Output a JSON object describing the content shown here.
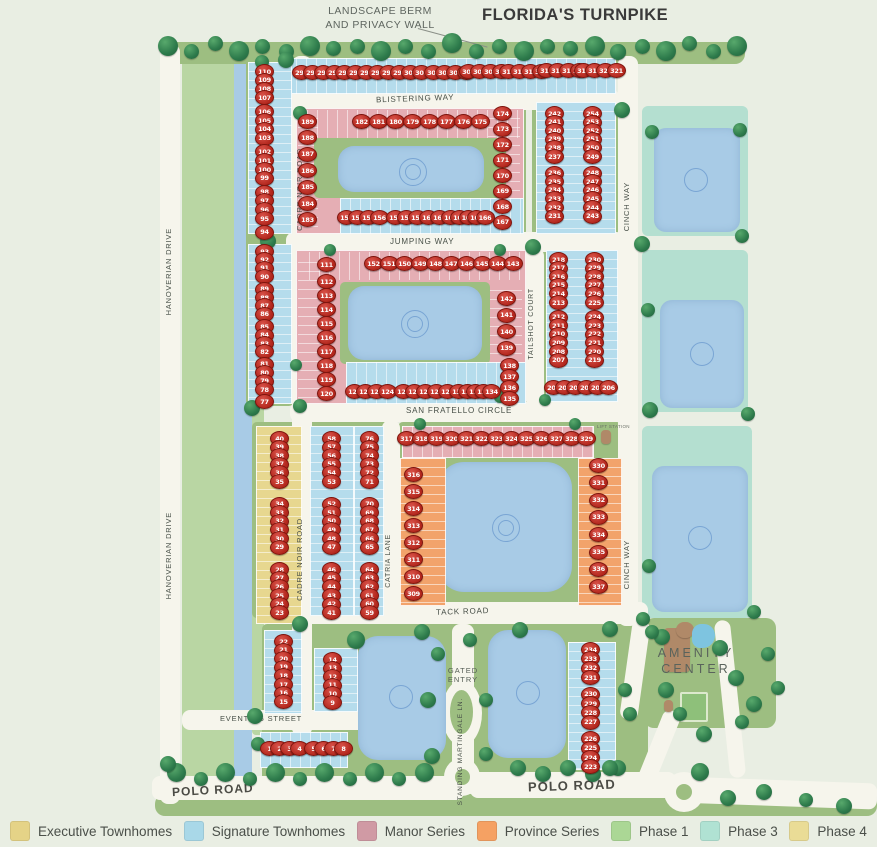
{
  "title": "FLORIDA'S TURNPIKE",
  "annotations": {
    "berm_line1": "LANDSCAPE BERM",
    "berm_line2": "AND PRIVACY WALL",
    "gated_line1": "GATED",
    "gated_line2": "ENTRY",
    "amenity_line1": "AMENITY",
    "amenity_line2": "CENTER",
    "lift_station": "LIFT STATION"
  },
  "roads": {
    "blistering": "BLISTERING WAY",
    "jumping": "JUMPING WAY",
    "fratello": "SAN FRATELLO CIRCLE",
    "tack": "TACK ROAD",
    "eventing": "EVENTING STREET",
    "polo_west": "POLO ROAD",
    "polo_east": "POLO ROAD",
    "cadre_north": "CADRE NOIR ROAD",
    "cadre_south": "CADRE NOIR ROAD",
    "hanoverian_north": "HANOVERIAN DRIVE",
    "hanoverian_south": "HANOVERIAN DRIVE",
    "cinch_north": "CINCH WAY",
    "cinch_south": "CINCH WAY",
    "tailshot": "TAILSHOT COURT",
    "catria": "CATRIA LANE",
    "standing": "STANDING MARTINGALE LN."
  },
  "legend": {
    "items": [
      {
        "label": "Executive Townhomes",
        "color": "#e5d387"
      },
      {
        "label": "Signature Townhomes",
        "color": "#a9d8e8"
      },
      {
        "label": "Manor Series",
        "color": "#d09aa4"
      },
      {
        "label": "Province Series",
        "color": "#f5a163"
      },
      {
        "label": "Phase 1",
        "color": "#abd795"
      },
      {
        "label": "Phase 3",
        "color": "#b0e2d3"
      },
      {
        "label": "Phase 4",
        "color": "#eadc96"
      }
    ]
  },
  "lots": {
    "segments": [
      {
        "id": "tpk1",
        "nums": [
          290,
          291,
          292,
          293
        ]
      },
      {
        "id": "tpk2",
        "nums": [
          294,
          295,
          296,
          297
        ]
      },
      {
        "id": "tpk3",
        "nums": [
          298,
          299,
          300,
          301
        ]
      },
      {
        "id": "tpk4",
        "nums": [
          302,
          303,
          304,
          305
        ]
      },
      {
        "id": "tpk5",
        "nums": [
          306,
          307,
          308,
          309
        ]
      },
      {
        "id": "tpk6",
        "nums": [
          310,
          311,
          312,
          313
        ]
      },
      {
        "id": "tpk7",
        "nums": [
          314,
          315,
          316,
          317
        ]
      },
      {
        "id": "tpk8",
        "nums": [
          318,
          319,
          320,
          321
        ]
      },
      {
        "id": "b1_left",
        "nums": [
          189,
          188,
          187,
          186,
          185,
          184,
          183
        ]
      },
      {
        "id": "b1_top",
        "nums": [
          182,
          181,
          180,
          179,
          178,
          177,
          176,
          175
        ]
      },
      {
        "id": "b1_right",
        "nums": [
          174,
          173,
          172,
          171,
          170,
          169,
          168,
          167
        ]
      },
      {
        "id": "b1_bot1",
        "nums": [
          153,
          154,
          155,
          156
        ]
      },
      {
        "id": "b1_bot2",
        "nums": [
          157,
          158,
          159,
          160,
          161,
          162
        ]
      },
      {
        "id": "b1_bot3",
        "nums": [
          163,
          164,
          165,
          166
        ]
      },
      {
        "id": "b2_corner",
        "nums": [
          111
        ]
      },
      {
        "id": "b2_left",
        "nums": [
          112,
          113,
          114,
          115,
          116,
          117,
          118,
          119,
          120
        ]
      },
      {
        "id": "b2_bot1",
        "nums": [
          121,
          122,
          123,
          124
        ]
      },
      {
        "id": "b2_bot2",
        "nums": [
          125,
          126,
          127,
          128,
          129,
          130
        ]
      },
      {
        "id": "b2_bot3",
        "nums": [
          131,
          132,
          133,
          134
        ]
      },
      {
        "id": "b2_rlow",
        "nums": [
          138,
          137,
          136,
          135
        ]
      },
      {
        "id": "b2_rup",
        "nums": [
          142,
          141,
          140,
          139
        ]
      },
      {
        "id": "b2_top",
        "nums": [
          152,
          151,
          150,
          149,
          148,
          147,
          146,
          145,
          144,
          143
        ]
      },
      {
        "id": "tail_bot",
        "nums": [
          201,
          202,
          203,
          204,
          205,
          206
        ]
      },
      {
        "id": "tail_left",
        "nums": [
          218,
          217,
          216,
          215,
          214,
          213,
          212,
          211,
          210,
          209,
          208,
          207
        ]
      },
      {
        "id": "tail_right",
        "nums": [
          230,
          229,
          228,
          227,
          226,
          225,
          224,
          223,
          222,
          221,
          220,
          219
        ]
      },
      {
        "id": "cinch_left",
        "nums": [
          242,
          241,
          240,
          239,
          238,
          237,
          236,
          235,
          234,
          233,
          232,
          231
        ]
      },
      {
        "id": "cinch_right",
        "nums": [
          254,
          253,
          252,
          251,
          250,
          249,
          248,
          247,
          246,
          245,
          244,
          243
        ]
      },
      {
        "id": "ctr_top",
        "nums": [
          317,
          318,
          319,
          320,
          321,
          322,
          323,
          324,
          325,
          326,
          327,
          328,
          329
        ]
      },
      {
        "id": "ctr_left",
        "nums": [
          316,
          315,
          314,
          313,
          312,
          311,
          310,
          309
        ]
      },
      {
        "id": "ctr_right",
        "nums": [
          330,
          331,
          332,
          333,
          334,
          335,
          336,
          337
        ]
      },
      {
        "id": "br_strip",
        "nums": [
          234,
          233,
          232,
          231,
          230,
          229,
          228,
          227,
          226,
          225,
          224,
          223
        ]
      },
      {
        "id": "ev_block",
        "nums": [
          14,
          13,
          12,
          11,
          10,
          9
        ]
      },
      {
        "id": "ls_strip",
        "nums": [
          22,
          21,
          20,
          19,
          18,
          17,
          16,
          15
        ]
      },
      {
        "id": "polo1",
        "nums": [
          1,
          2,
          3,
          4
        ]
      },
      {
        "id": "polo2",
        "nums": [
          5,
          6,
          7,
          8
        ]
      },
      {
        "id": "exec",
        "nums": [
          40,
          39,
          38,
          37,
          36,
          35,
          34,
          33,
          32,
          31,
          30,
          29,
          28,
          27,
          26,
          25,
          24,
          23
        ]
      },
      {
        "id": "cadre_e",
        "nums": [
          58,
          57,
          56,
          55,
          54,
          53,
          52,
          51,
          50,
          49,
          48,
          47,
          46,
          45,
          44,
          43,
          42,
          41
        ]
      },
      {
        "id": "catria_w",
        "nums": [
          76,
          75,
          74,
          73,
          72,
          71,
          70,
          69,
          68,
          67,
          66,
          65,
          64,
          63,
          62,
          61,
          60,
          59
        ]
      },
      {
        "id": "cadre_nu",
        "nums": [
          110,
          109,
          108,
          107,
          106,
          105,
          104,
          103,
          102,
          101,
          100,
          99,
          98,
          97,
          96,
          95,
          94
        ]
      },
      {
        "id": "cadre_nl",
        "nums": [
          93,
          92,
          91,
          90,
          89,
          88,
          87,
          86,
          85,
          84,
          83,
          82,
          81,
          80,
          79,
          78,
          77
        ]
      }
    ]
  },
  "colors": {
    "background": "#e9eee3",
    "road": "#f6f5ec",
    "block_green": "#9dbe81",
    "buffer_green": "#b9d6a3",
    "phase3_teal": "#b4dfd0",
    "water": "#a8cbe6",
    "signature_blue": "#b5dcec",
    "manor_pink": "#e5aeb4",
    "province_orange": "#f2a36b",
    "executive_yellow": "#e7d78f",
    "lot_marker_red": "#b3271d"
  }
}
